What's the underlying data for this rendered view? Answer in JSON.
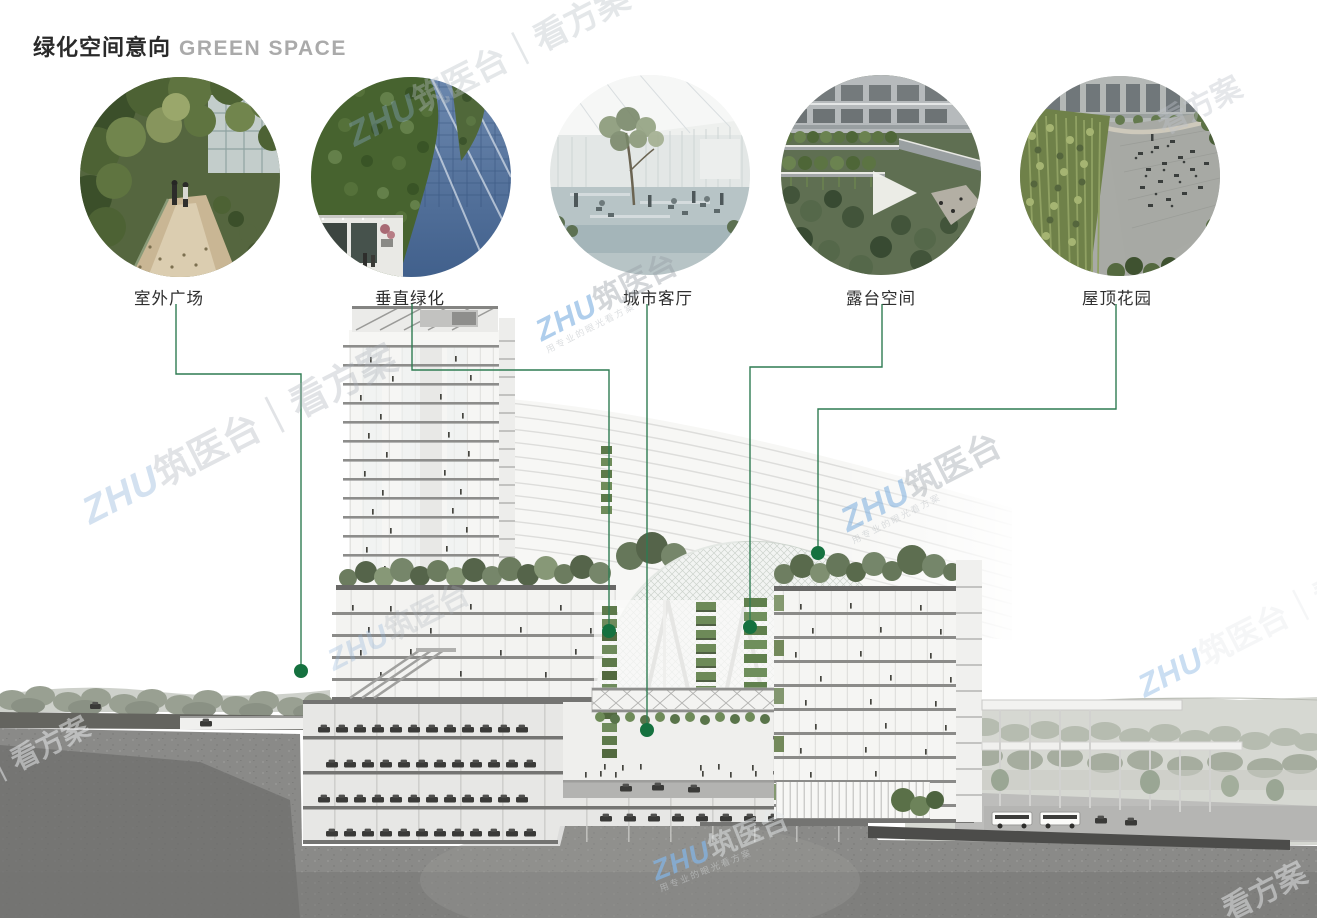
{
  "title": {
    "zh": "绿化空间意向",
    "en": "GREEN SPACE"
  },
  "legend_items": [
    {
      "id": "outdoor-plaza",
      "label": "室外广场"
    },
    {
      "id": "vertical-greening",
      "label": "垂直绿化"
    },
    {
      "id": "urban-living-room",
      "label": "城市客厅"
    },
    {
      "id": "terrace-space",
      "label": "露台空间"
    },
    {
      "id": "roof-garden",
      "label": "屋顶花园"
    }
  ],
  "watermark": {
    "brand": "ZHU",
    "site": "筑医台",
    "sep": "｜",
    "suffix": "看方案",
    "tagline": "用专业的眼光看方案"
  },
  "colors": {
    "leader_line": "#2f7c52",
    "leader_dot": "#15713f",
    "title_zh": "#2a2a2a",
    "title_en": "#aaaaaa",
    "watermark_blue": "#7aa9d8"
  }
}
